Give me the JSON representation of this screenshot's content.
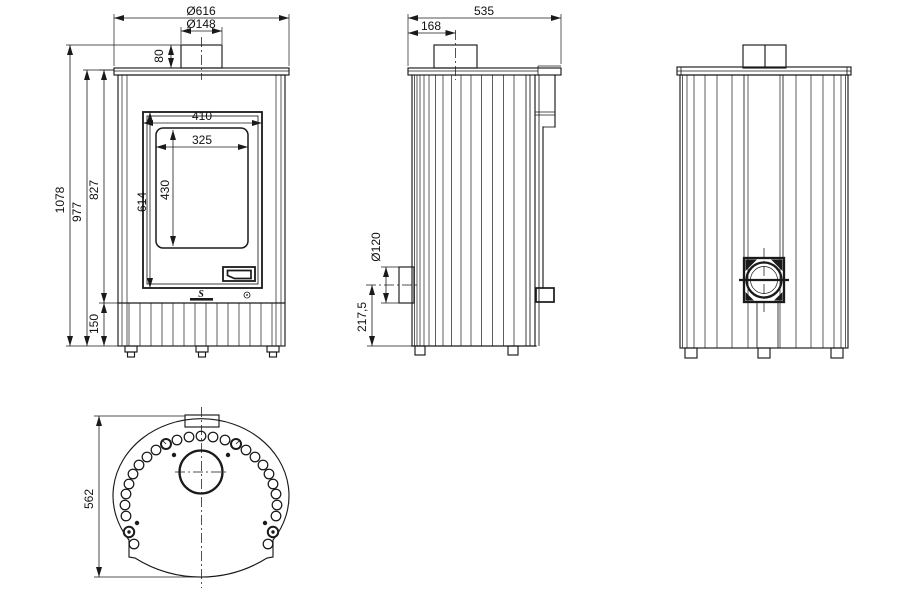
{
  "meta": {
    "type": "technical-drawing",
    "subject": "Round wood-burning stove — four orthographic views with dimensions (mm)"
  },
  "colors": {
    "line": "#1a1a1a",
    "background": "#ffffff"
  },
  "labels": {
    "front": {
      "overall_width": "Ø616",
      "flue_diameter": "Ø148",
      "collar_height": "80",
      "overall_height": "1078",
      "body_height": "977",
      "upper_height": "827",
      "base_height": "150",
      "door_height": "614",
      "door_width": "410",
      "glass_width": "325",
      "glass_height": "430",
      "logo": "S"
    },
    "side": {
      "depth": "535",
      "flue_offset": "168",
      "outlet_diameter": "Ø120",
      "outlet_height": "217,5"
    },
    "top": {
      "depth": "562"
    }
  }
}
